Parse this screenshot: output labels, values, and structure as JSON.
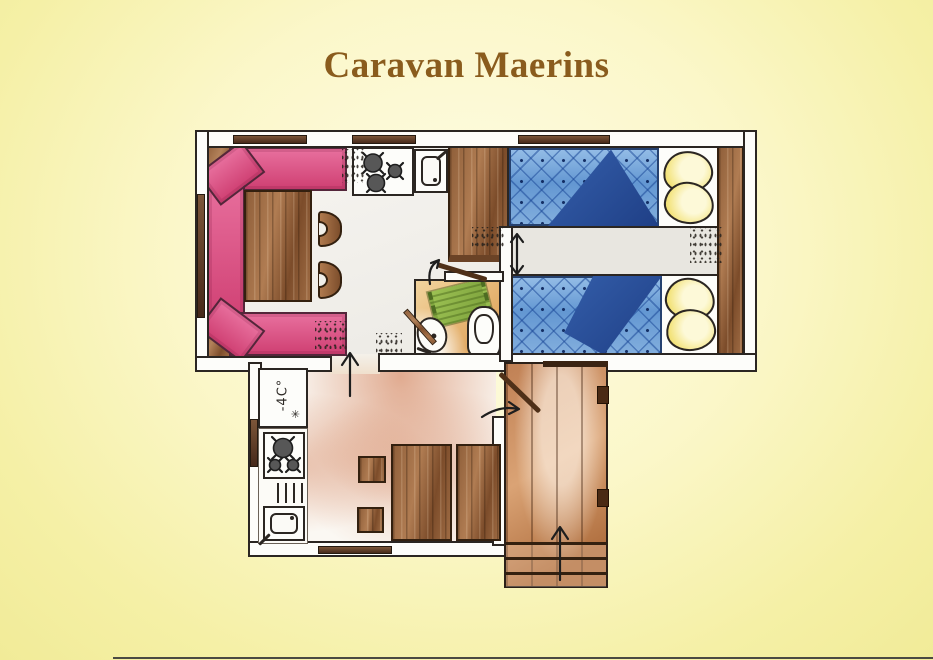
{
  "title": "Caravan Maerins",
  "floorplan": {
    "fridge": {
      "label": "-4C°",
      "frost_symbol": "✳"
    }
  },
  "colors": {
    "background_yellow": "#f4efa2",
    "title_brown": "#8a5c1d",
    "bench_pink": "#d9487b",
    "bed_blue": "#6b9cd4",
    "fold_blue": "#2e4f96",
    "pillow_yellow": "#f3e37c",
    "wood_brown": "#8f5f3a",
    "deck_brown": "#c08054",
    "bath_floor_tan": "#e8bc7e",
    "mat_green": "#8db24a"
  }
}
